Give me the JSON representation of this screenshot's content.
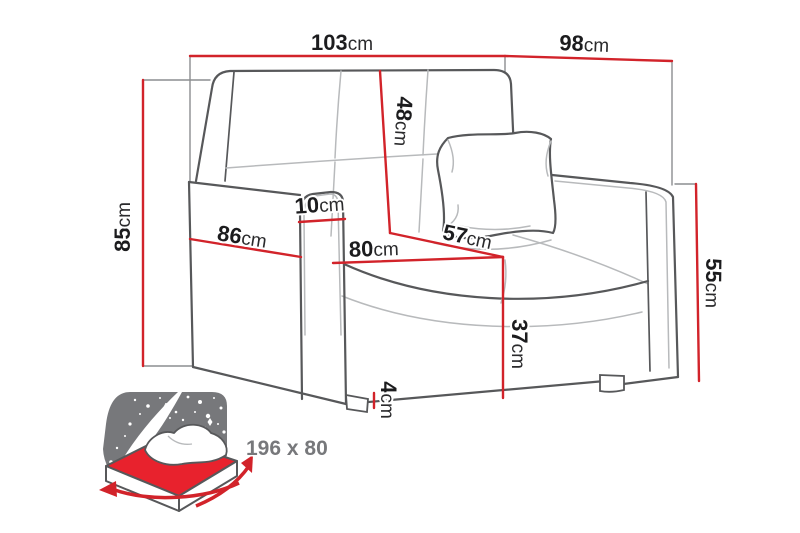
{
  "diagram": {
    "type": "furniture-dimension-diagram",
    "product": "sofa bed line drawing with measurements",
    "unit": "cm",
    "dimensions": {
      "total_width": {
        "value": "103",
        "unit": "cm"
      },
      "side_width": {
        "value": "98",
        "unit": "cm"
      },
      "total_height": {
        "value": "85",
        "unit": "cm"
      },
      "total_depth": {
        "value": "86",
        "unit": "cm"
      },
      "armrest_width": {
        "value": "10",
        "unit": "cm"
      },
      "seat_width": {
        "value": "80",
        "unit": "cm"
      },
      "seat_depth": {
        "value": "57",
        "unit": "cm"
      },
      "backrest_height": {
        "value": "48",
        "unit": "cm"
      },
      "armrest_height": {
        "value": "55",
        "unit": "cm"
      },
      "seat_height": {
        "value": "37",
        "unit": "cm"
      },
      "leg_height": {
        "value": "4",
        "unit": "cm"
      }
    },
    "sleeping_area": {
      "size_label": "196 x 80"
    },
    "colors": {
      "dimension_red": "#d2232a",
      "outline_gray": "#57585a",
      "seam_gray": "#b8babc",
      "icon_gray": "#77787b",
      "label_black": "#1c1c1e"
    }
  }
}
